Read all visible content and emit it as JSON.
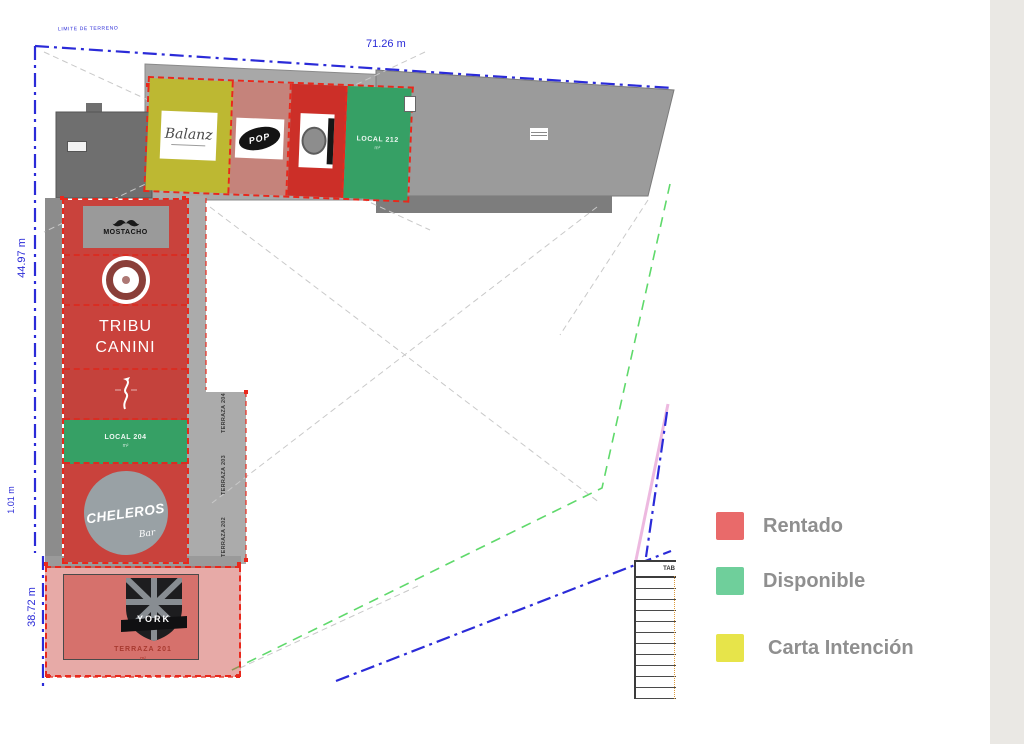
{
  "legend": {
    "items": [
      {
        "label": "Rentado",
        "color": "#e96a6a",
        "swatch_style": "background:#e96a6a"
      },
      {
        "label": "Disponible",
        "color": "#6fcf9b",
        "swatch_style": "background:#6fcf9b"
      },
      {
        "label": "Carta Intención",
        "color": "#e7e44a",
        "swatch_style": "background:#e7e44a"
      }
    ]
  },
  "dimensions": {
    "top": "71.26 m",
    "left_upper": "44.97 m",
    "left_mid": "1.01 m",
    "left_lower": "38.72 m",
    "boundary_label": "LIMITE DE TERRENO"
  },
  "status_colors": {
    "rentado": "#c9423c",
    "disponible": "#36a065",
    "carta_intencion": "#bdb832"
  },
  "top_row_units": [
    {
      "label": "Balanz",
      "status": "carta_intencion",
      "fill_style": "background:#bdb832"
    },
    {
      "label": "POP",
      "status": "rentado",
      "fill_style": "background:#c5837b"
    },
    {
      "label": "",
      "status": "rentado",
      "fill_style": "background:#cc2f28"
    },
    {
      "label": "LOCAL 212",
      "area": "m²",
      "status": "disponible",
      "fill_style": "background:#36a065"
    }
  ],
  "left_wing_units": [
    {
      "label": "MOSTACHO",
      "status": "rentado",
      "fill_style": "background:#c9423c"
    },
    {
      "label": "",
      "status": "rentado",
      "fill_style": "background:#c9423c"
    },
    {
      "line1": "TRIBU",
      "line2": "CANINI",
      "status": "rentado",
      "fill_style": "background:#c9423c"
    },
    {
      "label": "",
      "status": "rentado",
      "fill_style": "background:#c4423c"
    },
    {
      "label": "LOCAL 204",
      "area": "m²",
      "status": "disponible",
      "fill_style": "background:#36a065"
    },
    {
      "label": "CHELEROS",
      "sub": "Bar",
      "status": "rentado",
      "fill_style": "background:#c9423c"
    }
  ],
  "terrace": {
    "logo_text": "YORK",
    "label": "TERRAZA 201",
    "area": "m²",
    "fill_style": "background:rgba(201,66,60,0.45)",
    "inner_fill_style": "background:rgba(201,66,60,0.55)"
  },
  "walkway_labels": [
    "TERRAZA 204",
    "TERRAZA 203",
    "TERRAZA 202"
  ],
  "area_table": {
    "header": "TAB"
  }
}
